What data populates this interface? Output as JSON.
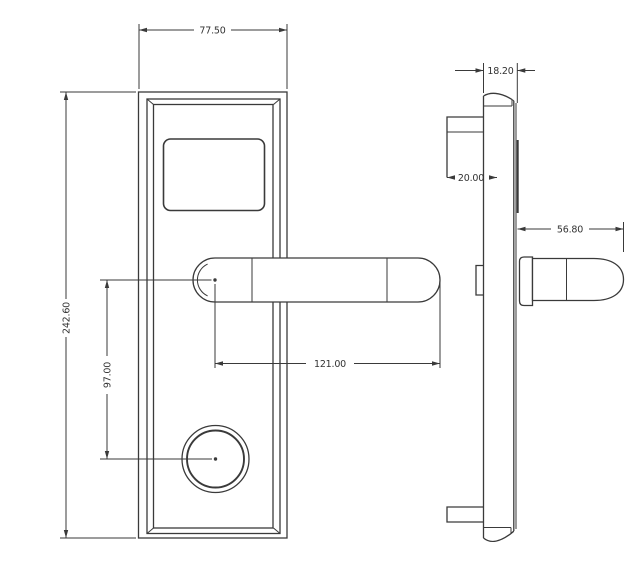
{
  "style": {
    "line_color": "#3a3a3a",
    "text_color": "#333333",
    "background": "#ffffff"
  },
  "drawing": {
    "front_view": {
      "dim_width": "77.50",
      "dim_height": "242.60",
      "dim_handle_to_cylinder": "97.00",
      "dim_handle_length": "121.00"
    },
    "side_view": {
      "dim_depth": "18.20",
      "dim_mortise": "20.00",
      "dim_handle_depth": "56.80"
    }
  }
}
